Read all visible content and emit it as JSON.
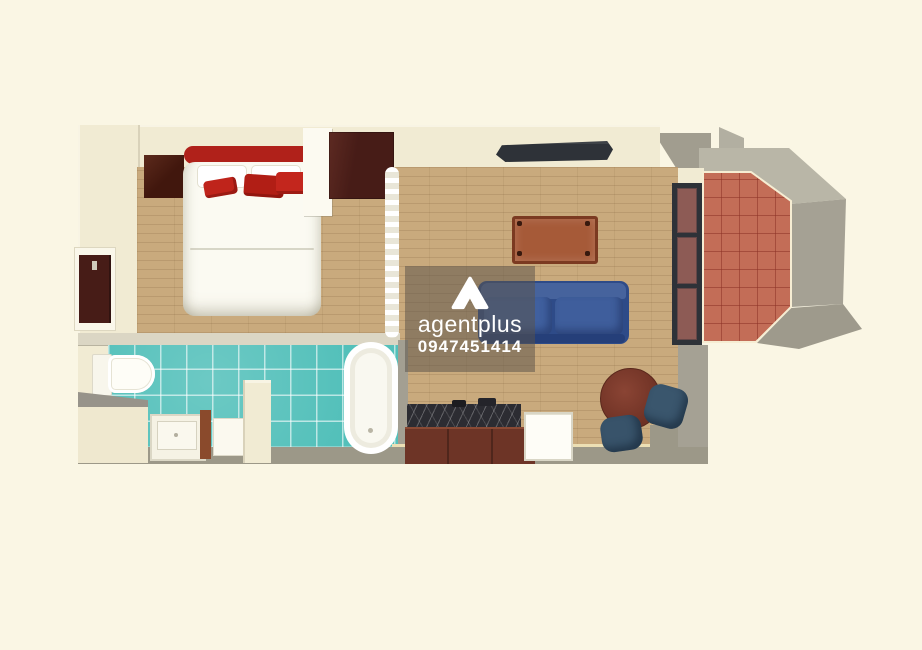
{
  "title": "3D apartment floor plan (top-down render)",
  "watermark": {
    "brand": "agentplus",
    "phone": "0947451414",
    "logo_icon": "triangle-a-logo"
  },
  "colors": {
    "bg": "#faf6e4",
    "wall": "#f1ebd3",
    "gray": "#9c9888",
    "gray-light": "#b9b6a7",
    "wood": "#c9aa7d",
    "teal": "#53c0ba",
    "terracotta": "#c36d57",
    "dark-wood": "#471c17",
    "bed-red": "#b0211a",
    "bed-white": "#fbfaf2",
    "sofa-blue": "#2e4b88",
    "chair-blue": "#3a566d",
    "table-brown": "#a65a38",
    "marble": "#2c2c32",
    "cabinet-brown": "#6d3426",
    "fixture-white": "#fefdf7",
    "tv-dark": "#2e3238",
    "overlay": "rgba(90,82,73,0.52)"
  },
  "scene": {
    "view": "top-down 3D floor plan",
    "rooms": [
      {
        "name": "bedroom",
        "items": [
          "double-bed",
          "red-headboard",
          "white-pillows",
          "red-pillows",
          "nightstand",
          "wardrobe",
          "entry-door",
          "room-divider-curtain"
        ]
      },
      {
        "name": "bathroom",
        "items": [
          "toilet",
          "vanity-sink",
          "storage-cabinet",
          "partition-wall",
          "bathtub",
          "teal-tile-floor"
        ]
      },
      {
        "name": "living-room",
        "items": [
          "wall-tv",
          "coffee-table",
          "blue-sofa",
          "round-dining-table",
          "two-dining-chairs",
          "wood-floor"
        ]
      },
      {
        "name": "kitchen",
        "items": [
          "marble-counter-with-sink",
          "lower-cabinets",
          "refrigerator"
        ]
      },
      {
        "name": "balcony",
        "items": [
          "glass-sliding-door",
          "terracotta-tile-floor",
          "gray-exterior-walls"
        ]
      }
    ]
  }
}
